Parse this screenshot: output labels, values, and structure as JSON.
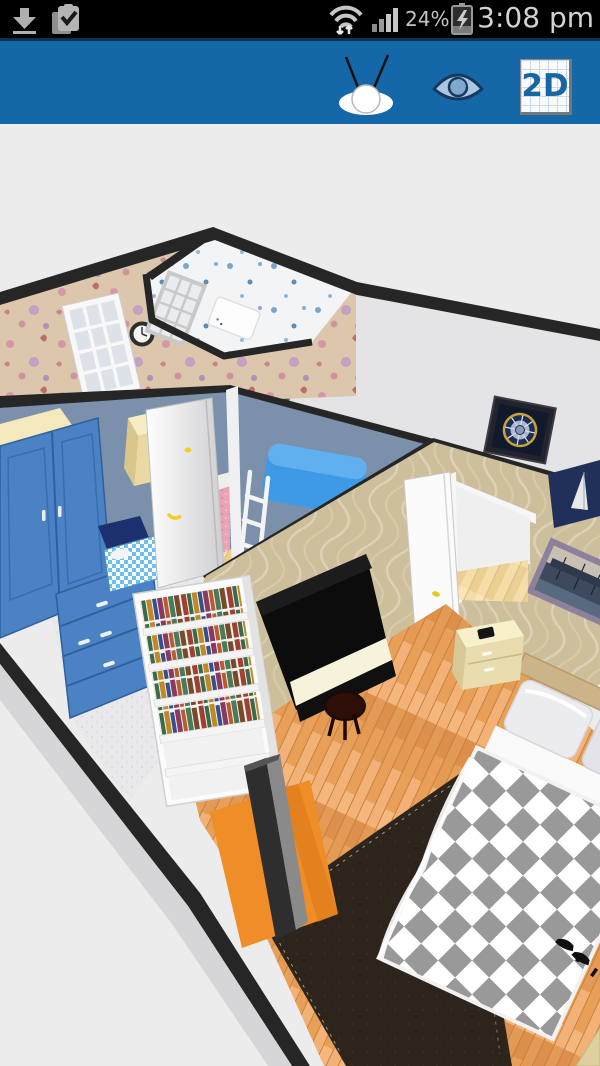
{
  "status_bar": {
    "time": "3:08 pm",
    "battery_percent": "24%",
    "icons": [
      "download-icon",
      "clipboard-check-icon",
      "wifi-arrows-icon",
      "signal-bars-icon",
      "battery-charging-icon"
    ]
  },
  "toolbar": {
    "buttons": [
      {
        "name": "walk-view-button",
        "icon": "person-top-view-icon"
      },
      {
        "name": "visibility-button",
        "icon": "eye-icon"
      },
      {
        "name": "2d-toggle-button",
        "label": "2D"
      }
    ]
  },
  "debug_overlay": {
    "line1": "2",
    "line2": "F: 0 D: false  pc = 1"
  },
  "scene": {
    "view": "3d-floorplan",
    "rooms": [
      "flower-wallpaper-room",
      "moon-wallpaper-room",
      "blue-kids-room",
      "hallway",
      "master-bedroom"
    ],
    "furniture": [
      "wall-clock",
      "window",
      "window",
      "bathtub",
      "blue-wardrobe",
      "cream-desk",
      "toy-bed",
      "bunk-bed-with-ladder",
      "open-door",
      "oval-mirror-door",
      "ceiling-medallion-picture",
      "sailboat-picture",
      "bookshelf",
      "upright-piano",
      "piano-stool",
      "tv-cabinet",
      "orange-mat",
      "dark-rug",
      "checkered-double-bed",
      "pillows",
      "nightstand",
      "phone",
      "harbor-picture",
      "high-heel-shoes"
    ]
  },
  "colors": {
    "status_black": "#000000",
    "toolbar_blue": "#1568a7",
    "scene_bg": "#ececec",
    "debug_yellow": "#ffff00",
    "wall_blue": "#7b90ab",
    "wallpaper_tan": "#cdbf9b",
    "flower_wall": "#dcc6ac",
    "moon_wall": "#f3f4f6",
    "wood_floor": "#eba766",
    "wardrobe_blue": "#4a82c4",
    "duvet_gray": "#999999",
    "rug_brown": "#2d251b",
    "mat_orange": "#ef8d26",
    "piano_black": "#0c0c0c",
    "band_dark": "#262626"
  }
}
